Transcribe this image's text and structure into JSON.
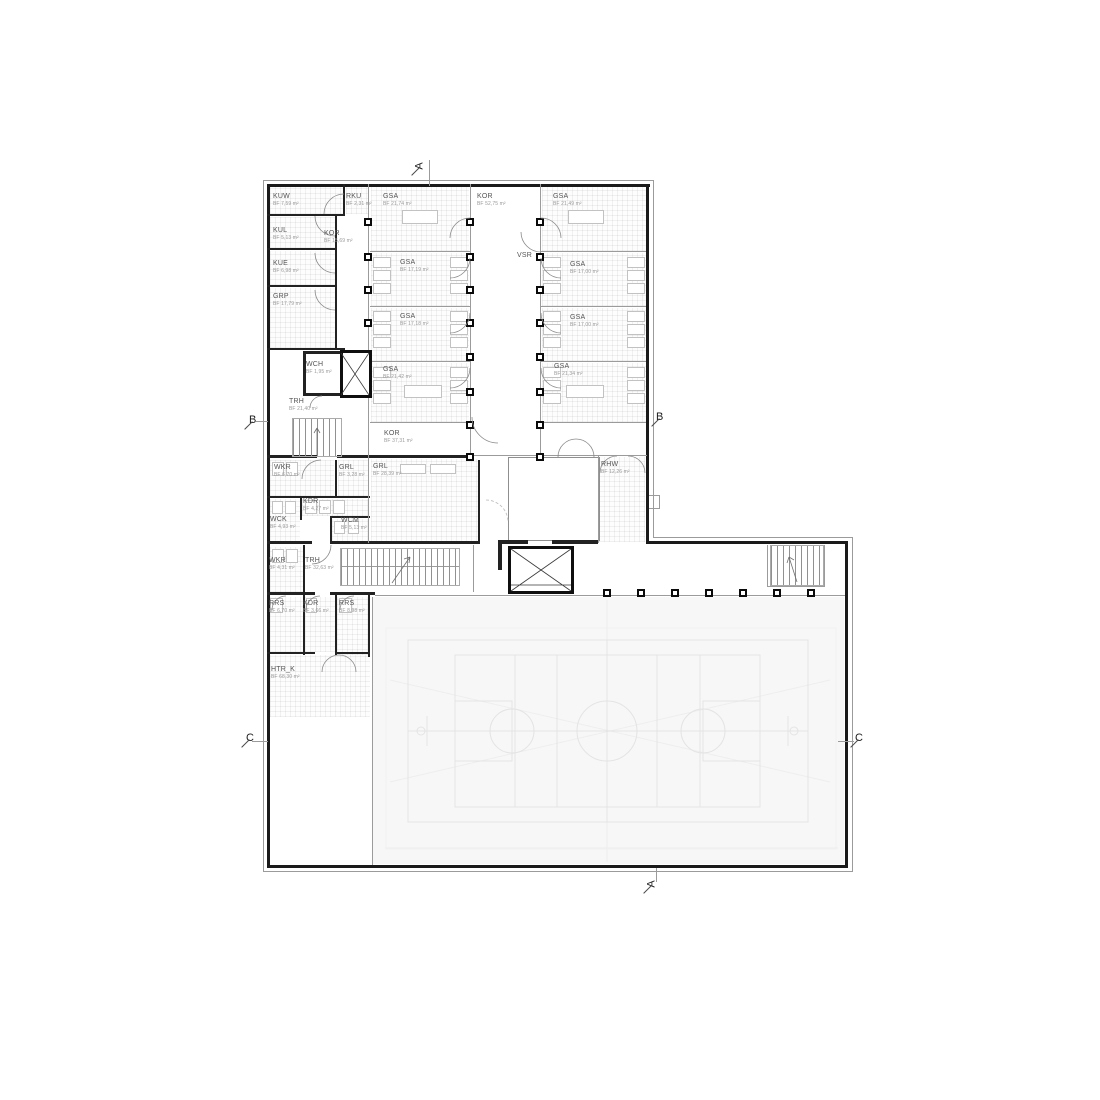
{
  "plan": {
    "title": "floor-plan",
    "area_prefix": "BF",
    "rooms": [
      {
        "code": "KUW",
        "area": "BF 7,59 m²",
        "x": 273,
        "y": 193
      },
      {
        "code": "RKU",
        "area": "BF 2,31 m²",
        "x": 346,
        "y": 193
      },
      {
        "code": "GSA",
        "area": "BF 21,74 m²",
        "x": 383,
        "y": 193
      },
      {
        "code": "KOR",
        "area": "BF 52,75 m²",
        "x": 477,
        "y": 193
      },
      {
        "code": "GSA",
        "area": "BF 21,49 m²",
        "x": 553,
        "y": 193
      },
      {
        "code": "KUL",
        "area": "BF 5,13 m²",
        "x": 273,
        "y": 227
      },
      {
        "code": "KOR",
        "area": "BF 15,69 m²",
        "x": 324,
        "y": 230
      },
      {
        "code": "KUE",
        "area": "BF 6,98 m²",
        "x": 273,
        "y": 260
      },
      {
        "code": "GRP",
        "area": "BF 17,79 m²",
        "x": 273,
        "y": 293
      },
      {
        "code": "GSA",
        "area": "BF 17,19 m²",
        "x": 400,
        "y": 259
      },
      {
        "code": "VSR",
        "area": "",
        "x": 517,
        "y": 252
      },
      {
        "code": "GSA",
        "area": "BF 17,00 m²",
        "x": 570,
        "y": 261
      },
      {
        "code": "GSA",
        "area": "BF 17,18 m²",
        "x": 400,
        "y": 313
      },
      {
        "code": "GSA",
        "area": "BF 17,00 m²",
        "x": 570,
        "y": 314
      },
      {
        "code": "WCH",
        "area": "BF 1,95 m²",
        "x": 306,
        "y": 361
      },
      {
        "code": "GSA",
        "area": "BF 21,42 m²",
        "x": 383,
        "y": 366
      },
      {
        "code": "GSA",
        "area": "BF 21,34 m²",
        "x": 554,
        "y": 363
      },
      {
        "code": "TRH",
        "area": "BF 21,40 m²",
        "x": 289,
        "y": 398
      },
      {
        "code": "KOR",
        "area": "BF 37,31 m²",
        "x": 384,
        "y": 430
      },
      {
        "code": "WKR",
        "area": "BF 6,70 m²",
        "x": 274,
        "y": 464
      },
      {
        "code": "GRL",
        "area": "BF 3,28 m²",
        "x": 339,
        "y": 464
      },
      {
        "code": "GRL",
        "area": "BF 28,39 m²",
        "x": 373,
        "y": 463
      },
      {
        "code": "RHW",
        "area": "BF 12,26 m²",
        "x": 601,
        "y": 461
      },
      {
        "code": "KDR",
        "area": "BF 4,27 m²",
        "x": 303,
        "y": 498
      },
      {
        "code": "WCK",
        "area": "BF 4,93 m²",
        "x": 270,
        "y": 516
      },
      {
        "code": "WCM",
        "area": "BF 5,13 m²",
        "x": 341,
        "y": 517
      },
      {
        "code": "WKR",
        "area": "BF 4,31 m²",
        "x": 269,
        "y": 557
      },
      {
        "code": "TRH",
        "area": "BF 32,63 m²",
        "x": 305,
        "y": 557
      },
      {
        "code": "RRS",
        "area": "BF 6,70 m²",
        "x": 269,
        "y": 600
      },
      {
        "code": "KDR",
        "area": "BF 3,66 m²",
        "x": 303,
        "y": 600
      },
      {
        "code": "RRS",
        "area": "BF 8,98 m²",
        "x": 339,
        "y": 600
      },
      {
        "code": "HTR_K",
        "area": "BF 68,30 m²",
        "x": 271,
        "y": 666
      }
    ],
    "markers": [
      {
        "label": "A",
        "x": 416,
        "y": 160,
        "rot": -90
      },
      {
        "label": "A",
        "x": 648,
        "y": 878,
        "rot": -90
      },
      {
        "label": "B",
        "x": 249,
        "y": 414,
        "rot": 0
      },
      {
        "label": "B",
        "x": 656,
        "y": 411,
        "rot": 0
      },
      {
        "label": "C",
        "x": 246,
        "y": 732,
        "rot": 0
      },
      {
        "label": "C",
        "x": 855,
        "y": 732,
        "rot": 0
      }
    ],
    "colors": {
      "wall": "#1a1a1a",
      "hall_floor": "#f7f7f7",
      "court_line": "#e5e5e5",
      "code_text": "#555555",
      "area_text": "#9a9a9a"
    }
  }
}
